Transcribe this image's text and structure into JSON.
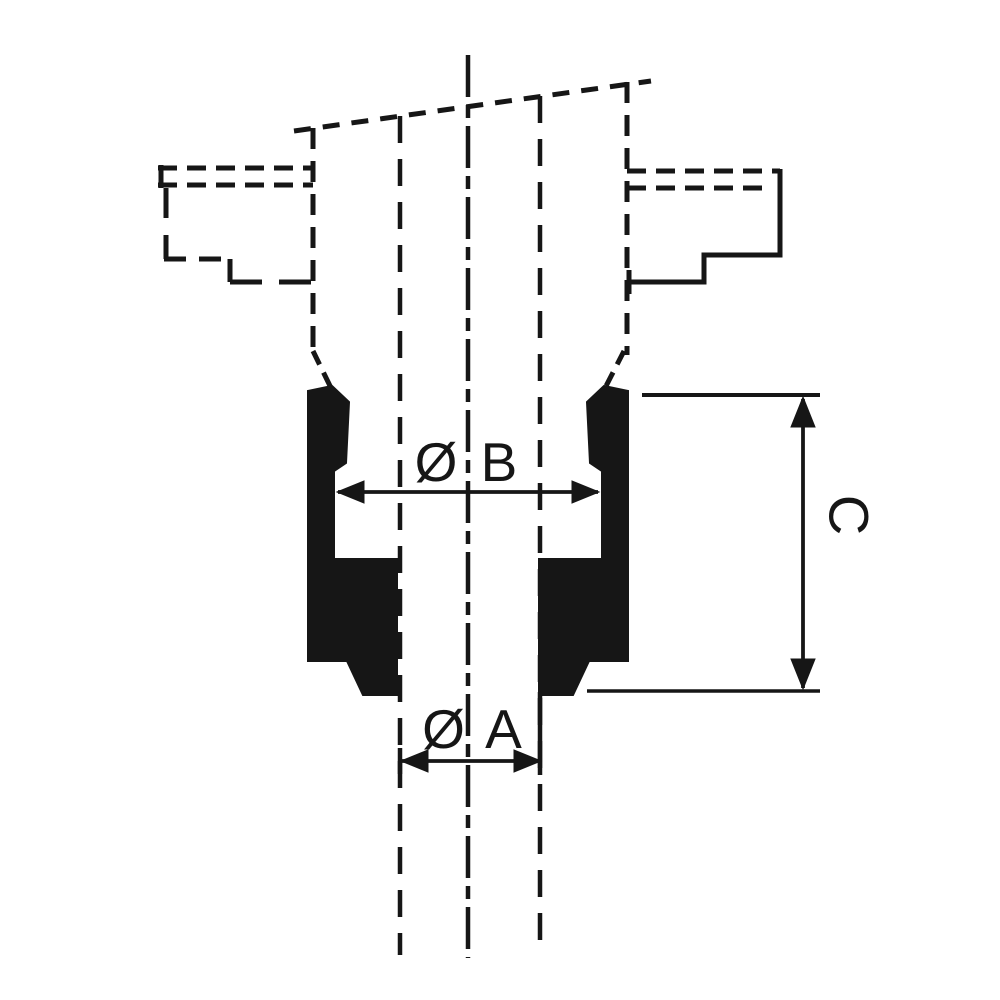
{
  "drawing": {
    "kind": "technical-cross-section",
    "description": "Cross-section of a grooved ring part clamped in stepped chuck jaws, with diameter and height dimensions",
    "labels": {
      "diameter_b": "Ø B",
      "diameter_a": "Ø A",
      "height_c": "C"
    },
    "colors": {
      "ink": "#161616",
      "background": "#ffffff"
    }
  }
}
